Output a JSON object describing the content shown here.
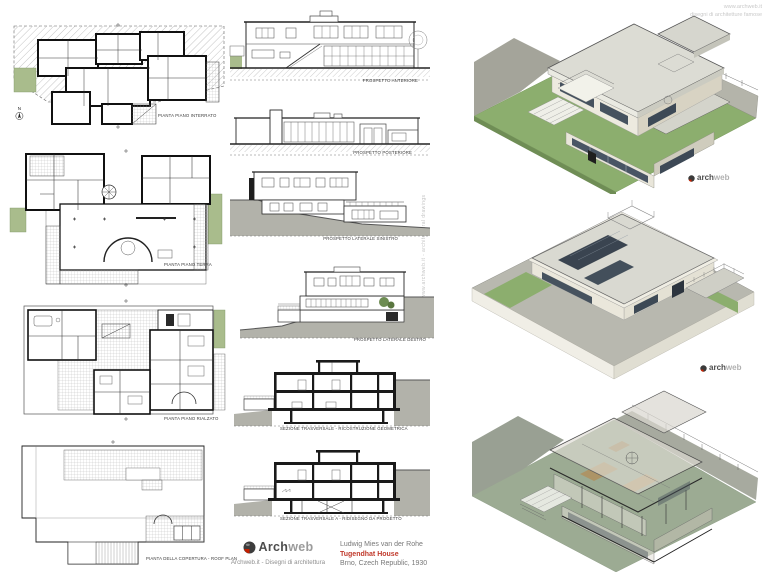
{
  "sheet": {
    "title_block": {
      "architect": "Ludwig Mies van der Rohe",
      "project": "Tugendhat House",
      "location": "Brno, Czech Republic, 1930"
    },
    "logo": {
      "arch": "Arch",
      "web": "web",
      "tagline": "Archweb.it - Disegni di architettura"
    },
    "corner_watermark": {
      "line1": "www.archweb.it",
      "line2": "disegni di architetture famose"
    },
    "side_watermark": "www.archweb.it - architectural drawings",
    "render_watermark": {
      "arch": "arch",
      "web": "web"
    },
    "compass_north": "N"
  },
  "drawings": {
    "plan_interrato": "PIANTA PIANO INTERRATO",
    "plan_terra": "PIANTA PIANO TERRA",
    "plan_rialzato": "PIANTA PIANO RIALZATO",
    "plan_copertura": "PIANTA DELLA COPERTURA  - ROOF PLAN",
    "prospetto_anteriore": "PROSPETTO ANTERIORE",
    "prospetto_posteriore": "PROSPETTO POSTERIORE",
    "prospetto_laterale_sinistro": "PROSPETTO LATERALE SINISTRO",
    "prospetto_laterale_destro": "PROSPETTO LATERALE DESTRO",
    "sezione_geometrica": "SEZIONE TRASVERSALE - RICOSTRUZIONE GEOMETRICA",
    "sezione_progetto": "SEZIONE TRASVERSALE  A - RIDISEGNO DA PROGETTO"
  },
  "colors": {
    "accent_red": "#c0392b",
    "plan_green": "#a9bc8c",
    "render_lawn_green": "#8cae6e",
    "render_muted_green": "#9cab93",
    "render_roof_gray": "#dadad2",
    "hill_gray": "#b2b2aa",
    "glazing_dark": "#46525f",
    "text_gray": "#8a8a8a",
    "watermark_gray": "#c9c9c9"
  }
}
